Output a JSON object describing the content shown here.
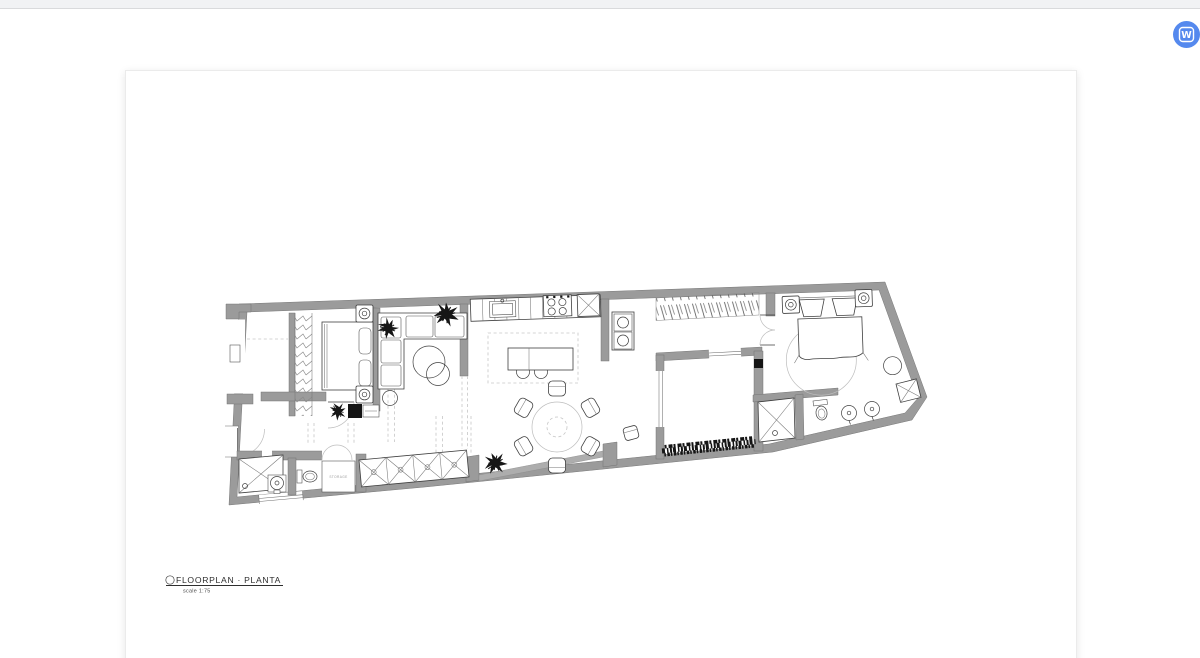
{
  "chrome": {
    "badge_letter": "W",
    "badge_color": "#5589ee",
    "topbar_color": "#f1f2f4"
  },
  "sheet": {
    "title": "FLOORPLAN · PLANTA",
    "scale_label": "scale 1:75",
    "storage_label": "STORAGE"
  },
  "palette": {
    "wall_gray": "#9b9b9b",
    "line_ink": "#3f3f3f",
    "page_background": "#ffffff"
  }
}
